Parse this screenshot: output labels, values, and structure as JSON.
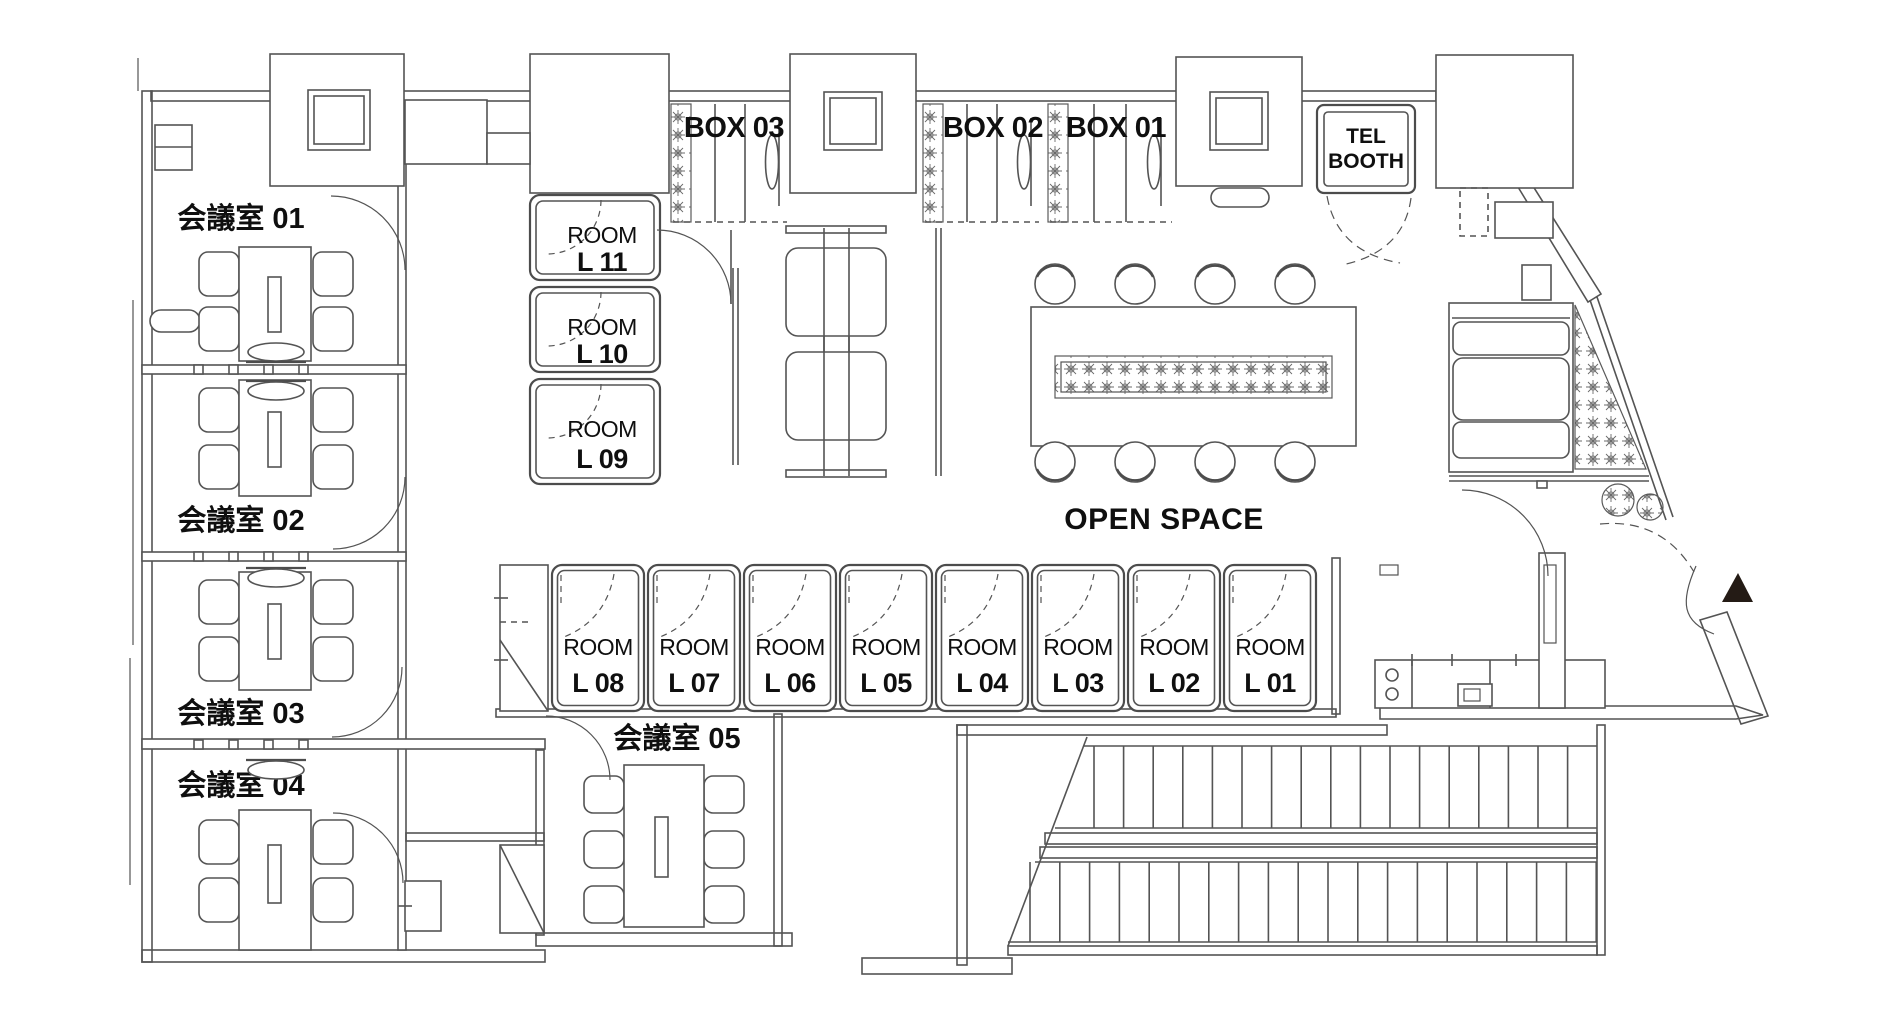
{
  "floor": {
    "meeting_rooms": [
      {
        "label": "会議室 01"
      },
      {
        "label": "会議室 02"
      },
      {
        "label": "会議室 03"
      },
      {
        "label": "会議室 04"
      },
      {
        "label": "会議室 05"
      }
    ],
    "box_rooms": [
      {
        "label": "BOX 03"
      },
      {
        "label": "BOX 02"
      },
      {
        "label": "BOX 01"
      }
    ],
    "tel_booth": {
      "line1": "TEL",
      "line2": "BOOTH"
    },
    "open_space_label": "OPEN SPACE",
    "left_rooms": [
      {
        "line1": "ROOM",
        "line2": "L 11"
      },
      {
        "line1": "ROOM",
        "line2": "L 10"
      },
      {
        "line1": "ROOM",
        "line2": "L 09"
      }
    ],
    "bottom_rooms": [
      {
        "line1": "ROOM",
        "line2": "L 08"
      },
      {
        "line1": "ROOM",
        "line2": "L 07"
      },
      {
        "line1": "ROOM",
        "line2": "L 06"
      },
      {
        "line1": "ROOM",
        "line2": "L 05"
      },
      {
        "line1": "ROOM",
        "line2": "L 04"
      },
      {
        "line1": "ROOM",
        "line2": "L 03"
      },
      {
        "line1": "ROOM",
        "line2": "L 02"
      },
      {
        "line1": "ROOM",
        "line2": "L 01"
      }
    ]
  }
}
